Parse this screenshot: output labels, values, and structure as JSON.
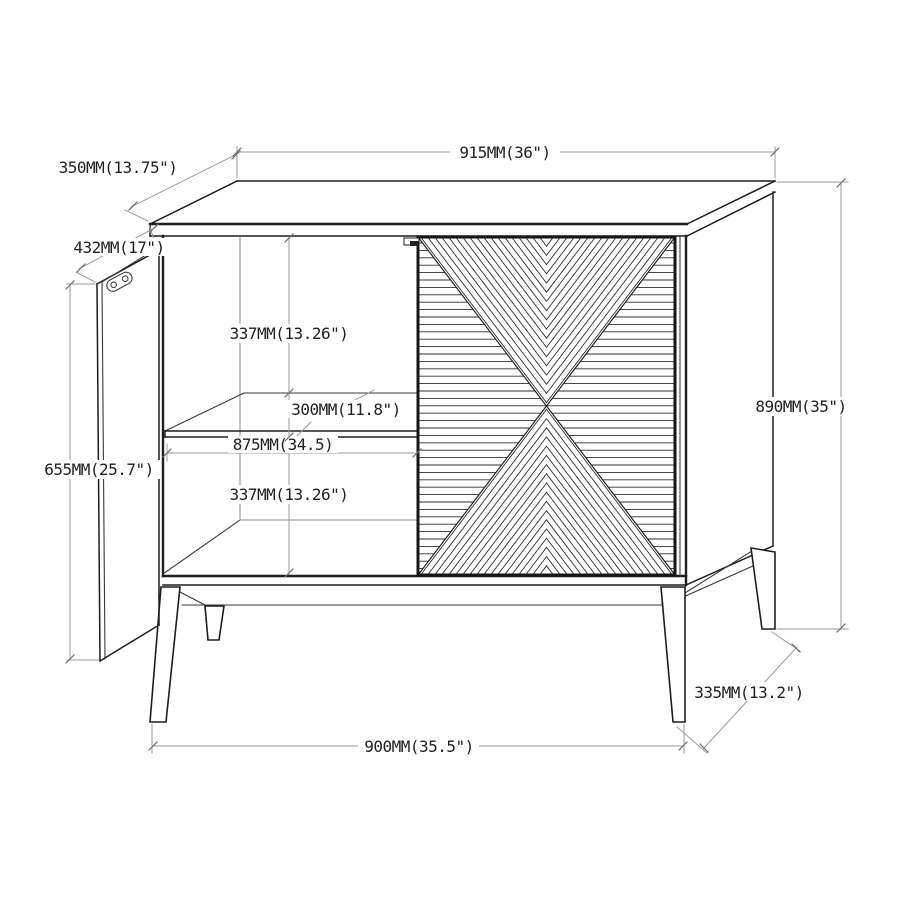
{
  "figure": {
    "type": "furniture-dimension-diagram",
    "subject": "two-door accent cabinet with open left door and chevron-pattern right door"
  },
  "dimensions": {
    "top_width": "915MM(36\")",
    "top_depth": "350MM(13.75\")",
    "door_width": "432MM(17\")",
    "upper_compartment_height": "337MM(13.26\")",
    "shelf_depth": "300MM(11.8\")",
    "interior_width": "875MM(34.5)",
    "lower_compartment_height": "337MM(13.26\")",
    "door_height": "655MM(25.7\")",
    "overall_height": "890MM(35\")",
    "base_depth": "335MM(13.2\")",
    "base_width": "900MM(35.5\")"
  },
  "colors": {
    "background": "#ffffff",
    "outline": "#1e1e1e",
    "dimension_line": "#9a9a9a",
    "text": "#1f1f1f"
  }
}
